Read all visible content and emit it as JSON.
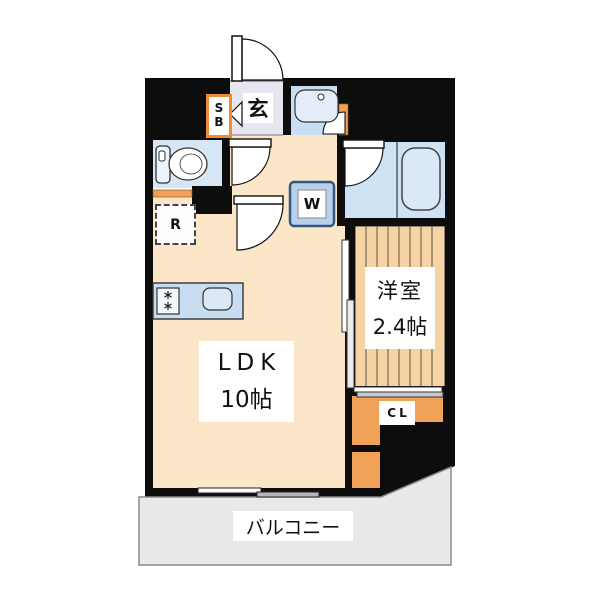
{
  "floorplan": {
    "entrance_label": "玄",
    "shoe_box_label": "S\nB",
    "refrigerator_label": "R",
    "washer_label": "W",
    "closet_label": "CL",
    "ldk": {
      "name": "LDK",
      "size": "10帖"
    },
    "western_room": {
      "name": "洋室",
      "size": "2.4帖"
    },
    "balcony_label": "バルコニー",
    "colors": {
      "wall_black": "#0d0d0d",
      "floor_cream": "#fbe6c8",
      "entrance_gray": "#e6e6f0",
      "wet_area_blue": "#cfe2f4",
      "wood_tan": "#f5d3a4",
      "accent_orange": "#f2a159",
      "balcony_gray": "#e9e9e9"
    }
  }
}
